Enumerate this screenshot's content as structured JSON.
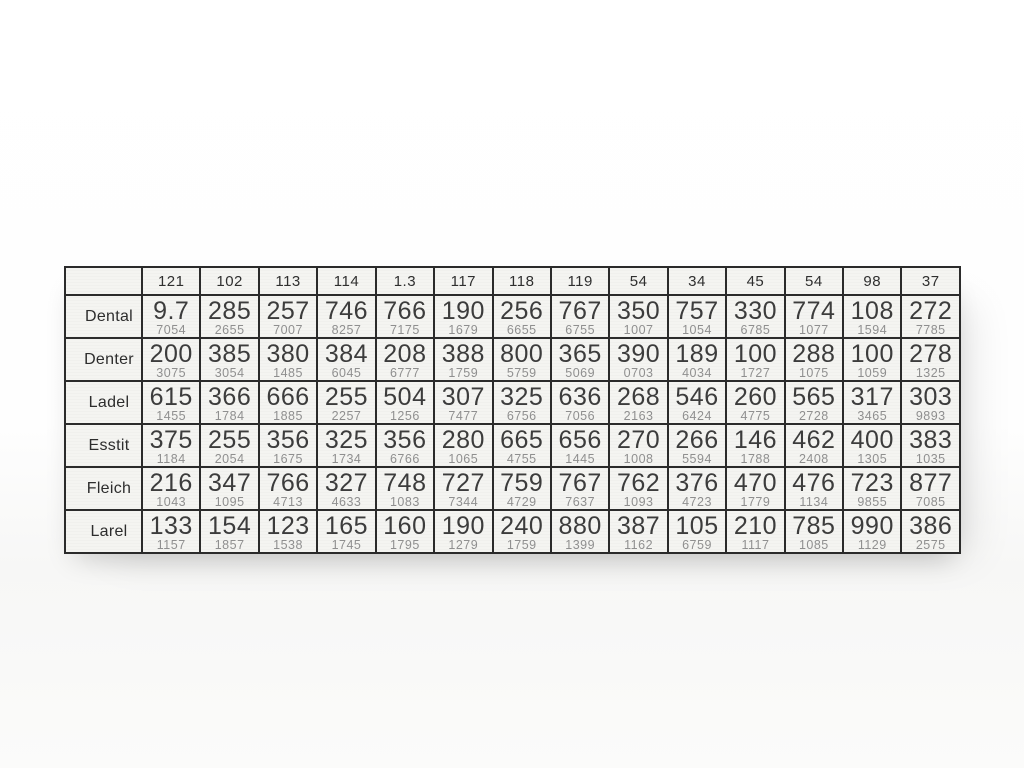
{
  "colors": {
    "grid_border": "#2b2b2b",
    "table_background": "#f4f4f1",
    "main_value_text": "#3c3c3c",
    "sub_value_text": "#8f8f8f",
    "label_text": "#2d2d2d"
  },
  "table": {
    "corner_label": "",
    "columns": [
      "121",
      "102",
      "113",
      "114",
      "1.3",
      "117",
      "118",
      "119",
      "54",
      "34",
      "45",
      "54",
      "98",
      "37"
    ],
    "rows": [
      {
        "label": "Dental",
        "cells": [
          {
            "main": "9.7",
            "sub": "7054"
          },
          {
            "main": "285",
            "sub": "2655"
          },
          {
            "main": "257",
            "sub": "7007"
          },
          {
            "main": "746",
            "sub": "8257"
          },
          {
            "main": "766",
            "sub": "7175"
          },
          {
            "main": "190",
            "sub": "1679"
          },
          {
            "main": "256",
            "sub": "6655"
          },
          {
            "main": "767",
            "sub": "6755"
          },
          {
            "main": "350",
            "sub": "1007"
          },
          {
            "main": "757",
            "sub": "1054"
          },
          {
            "main": "330",
            "sub": "6785"
          },
          {
            "main": "774",
            "sub": "1077"
          },
          {
            "main": "108",
            "sub": "1594"
          },
          {
            "main": "272",
            "sub": "7785"
          }
        ]
      },
      {
        "label": "Denter",
        "cells": [
          {
            "main": "200",
            "sub": "3075"
          },
          {
            "main": "385",
            "sub": "3054"
          },
          {
            "main": "380",
            "sub": "1485"
          },
          {
            "main": "384",
            "sub": "6045"
          },
          {
            "main": "208",
            "sub": "6777"
          },
          {
            "main": "388",
            "sub": "1759"
          },
          {
            "main": "800",
            "sub": "5759"
          },
          {
            "main": "365",
            "sub": "5069"
          },
          {
            "main": "390",
            "sub": "0703"
          },
          {
            "main": "189",
            "sub": "4034"
          },
          {
            "main": "100",
            "sub": "1727"
          },
          {
            "main": "288",
            "sub": "1075"
          },
          {
            "main": "100",
            "sub": "1059"
          },
          {
            "main": "278",
            "sub": "1325"
          }
        ]
      },
      {
        "label": "Ladel",
        "cells": [
          {
            "main": "615",
            "sub": "1455"
          },
          {
            "main": "366",
            "sub": "1784"
          },
          {
            "main": "666",
            "sub": "1885"
          },
          {
            "main": "255",
            "sub": "2257"
          },
          {
            "main": "504",
            "sub": "1256"
          },
          {
            "main": "307",
            "sub": "7477"
          },
          {
            "main": "325",
            "sub": "6756"
          },
          {
            "main": "636",
            "sub": "7056"
          },
          {
            "main": "268",
            "sub": "2163"
          },
          {
            "main": "546",
            "sub": "6424"
          },
          {
            "main": "260",
            "sub": "4775"
          },
          {
            "main": "565",
            "sub": "2728"
          },
          {
            "main": "317",
            "sub": "3465"
          },
          {
            "main": "303",
            "sub": "9893"
          }
        ]
      },
      {
        "label": "Esstit",
        "cells": [
          {
            "main": "375",
            "sub": "1184"
          },
          {
            "main": "255",
            "sub": "2054"
          },
          {
            "main": "356",
            "sub": "1675"
          },
          {
            "main": "325",
            "sub": "1734"
          },
          {
            "main": "356",
            "sub": "6766"
          },
          {
            "main": "280",
            "sub": "1065"
          },
          {
            "main": "665",
            "sub": "4755"
          },
          {
            "main": "656",
            "sub": "1445"
          },
          {
            "main": "270",
            "sub": "1008"
          },
          {
            "main": "266",
            "sub": "5594"
          },
          {
            "main": "146",
            "sub": "1788"
          },
          {
            "main": "462",
            "sub": "2408"
          },
          {
            "main": "400",
            "sub": "1305"
          },
          {
            "main": "383",
            "sub": "1035"
          }
        ]
      },
      {
        "label": "Fleich",
        "cells": [
          {
            "main": "216",
            "sub": "1043"
          },
          {
            "main": "347",
            "sub": "1095"
          },
          {
            "main": "766",
            "sub": "4713"
          },
          {
            "main": "327",
            "sub": "4633"
          },
          {
            "main": "748",
            "sub": "1083"
          },
          {
            "main": "727",
            "sub": "7344"
          },
          {
            "main": "759",
            "sub": "4729"
          },
          {
            "main": "767",
            "sub": "7637"
          },
          {
            "main": "762",
            "sub": "1093"
          },
          {
            "main": "376",
            "sub": "4723"
          },
          {
            "main": "470",
            "sub": "1779"
          },
          {
            "main": "476",
            "sub": "1134"
          },
          {
            "main": "723",
            "sub": "9855"
          },
          {
            "main": "877",
            "sub": "7085"
          }
        ]
      },
      {
        "label": "Larel",
        "cells": [
          {
            "main": "133",
            "sub": "1157"
          },
          {
            "main": "154",
            "sub": "1857"
          },
          {
            "main": "123",
            "sub": "1538"
          },
          {
            "main": "165",
            "sub": "1745"
          },
          {
            "main": "160",
            "sub": "1795"
          },
          {
            "main": "190",
            "sub": "1279"
          },
          {
            "main": "240",
            "sub": "1759"
          },
          {
            "main": "880",
            "sub": "1399"
          },
          {
            "main": "387",
            "sub": "1162"
          },
          {
            "main": "105",
            "sub": "6759"
          },
          {
            "main": "210",
            "sub": "1117"
          },
          {
            "main": "785",
            "sub": "1085"
          },
          {
            "main": "990",
            "sub": "1129"
          },
          {
            "main": "386",
            "sub": "2575"
          }
        ]
      }
    ]
  }
}
